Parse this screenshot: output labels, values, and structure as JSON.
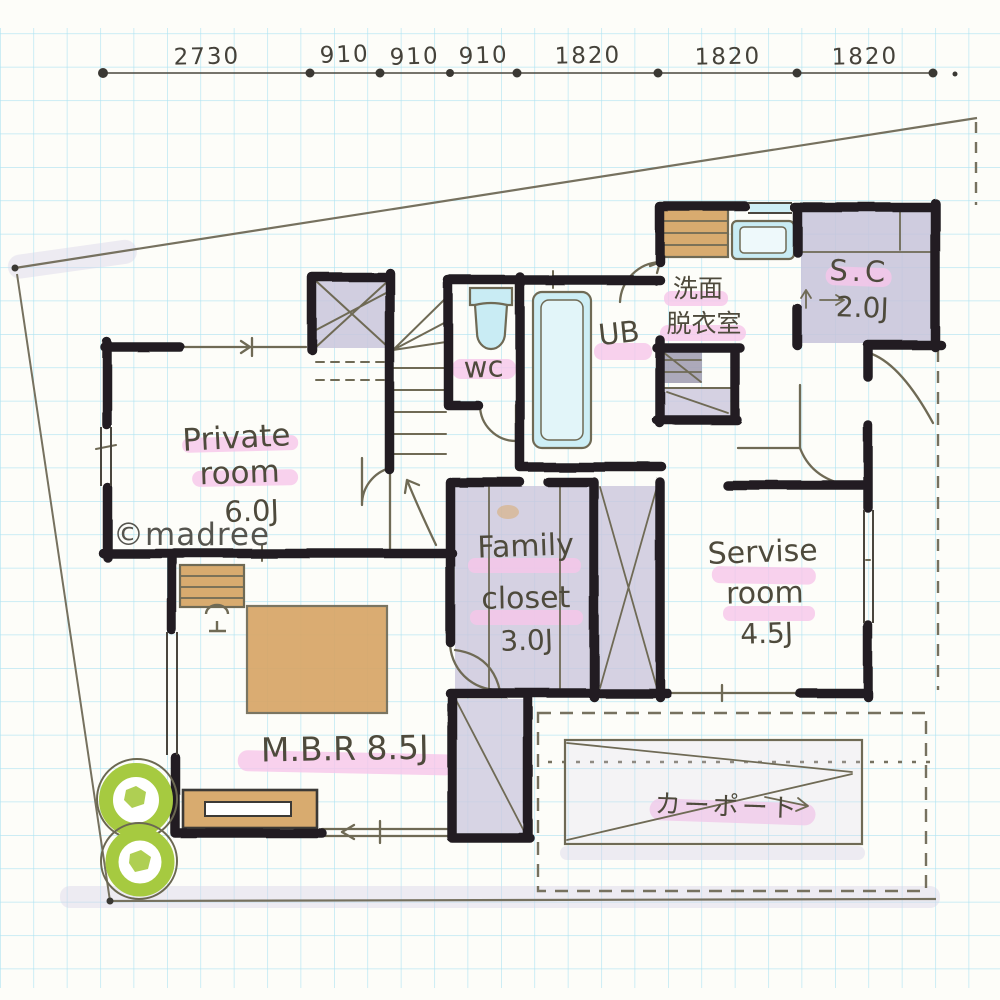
{
  "watermark": "©madree",
  "dimension_labels": [
    "2730",
    "910",
    "910",
    "910",
    "1820",
    "1820",
    "1820"
  ],
  "rooms": {
    "private_room": {
      "line1": "Private",
      "line2": "room",
      "size": "6.0J"
    },
    "toilet": {
      "label": "wc"
    },
    "bath": {
      "label": "UB"
    },
    "washroom": {
      "line1": "洗面",
      "line2": "脱衣室"
    },
    "shoes_closet": {
      "label": "S.C",
      "size": "2.0J"
    },
    "family_closet": {
      "line1": "Family",
      "line2": "closet",
      "size": "3.0J"
    },
    "service_room": {
      "line1": "Servise",
      "line2": "room",
      "size": "4.5J"
    },
    "master_bedroom": {
      "label": "M.B.R 8.5J"
    },
    "carport": {
      "label": "カーポート"
    }
  },
  "colors": {
    "grid_line": "#9adcf0",
    "wall_ink": "#211f22",
    "pen_ink": "#6f6a55",
    "highlight_pink": "#f7c6ea",
    "room_lavender": "#c9c5dc",
    "fixture_cyan": "#c9ecf4",
    "wood_tan": "#d8a96a",
    "bush_green": "#a6ca40"
  }
}
